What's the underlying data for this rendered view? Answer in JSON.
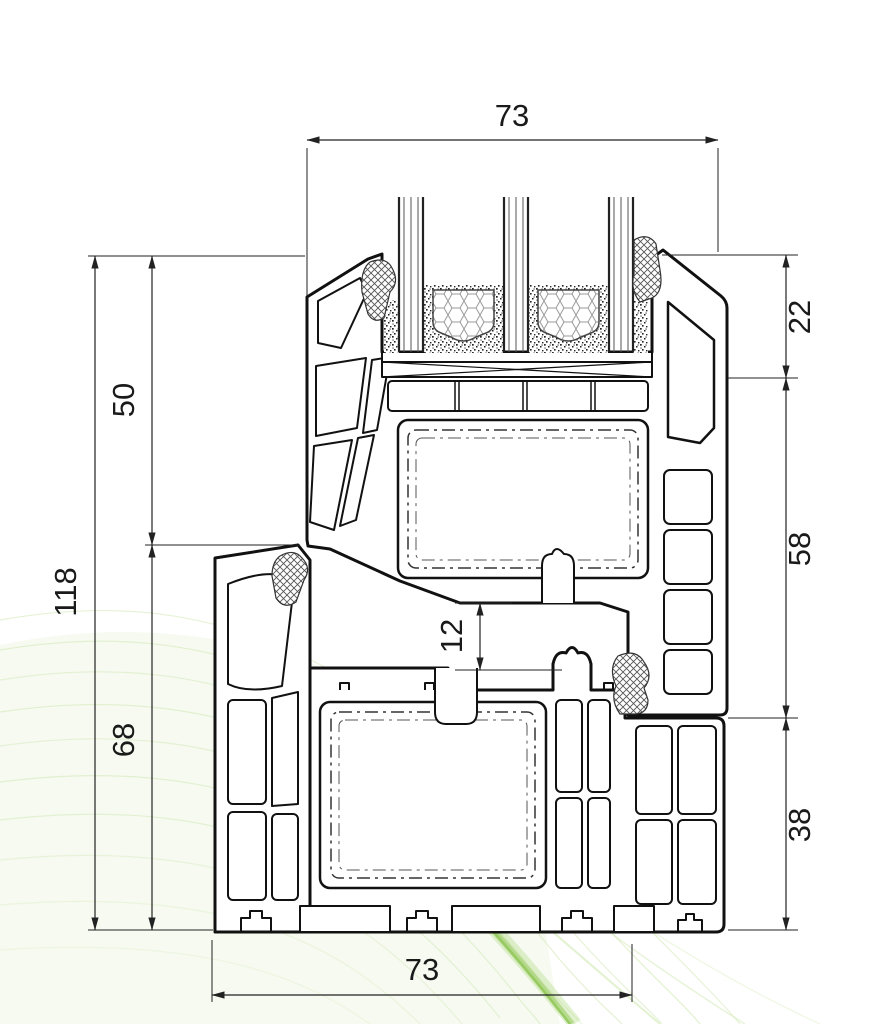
{
  "drawing": {
    "dimensions": {
      "top_width": "73",
      "glazing_depth": "22",
      "sash_height": "58",
      "frame_right_height": "38",
      "total_height": "118",
      "sash_left_height": "50",
      "frame_left_height": "68",
      "rebate_gap": "12",
      "bottom_width": "73"
    },
    "colors": {
      "line": "#1a1a1a",
      "dimension": "#222222",
      "accent_green": "#8cc152",
      "accent_green_light": "#e4f2d2"
    }
  }
}
